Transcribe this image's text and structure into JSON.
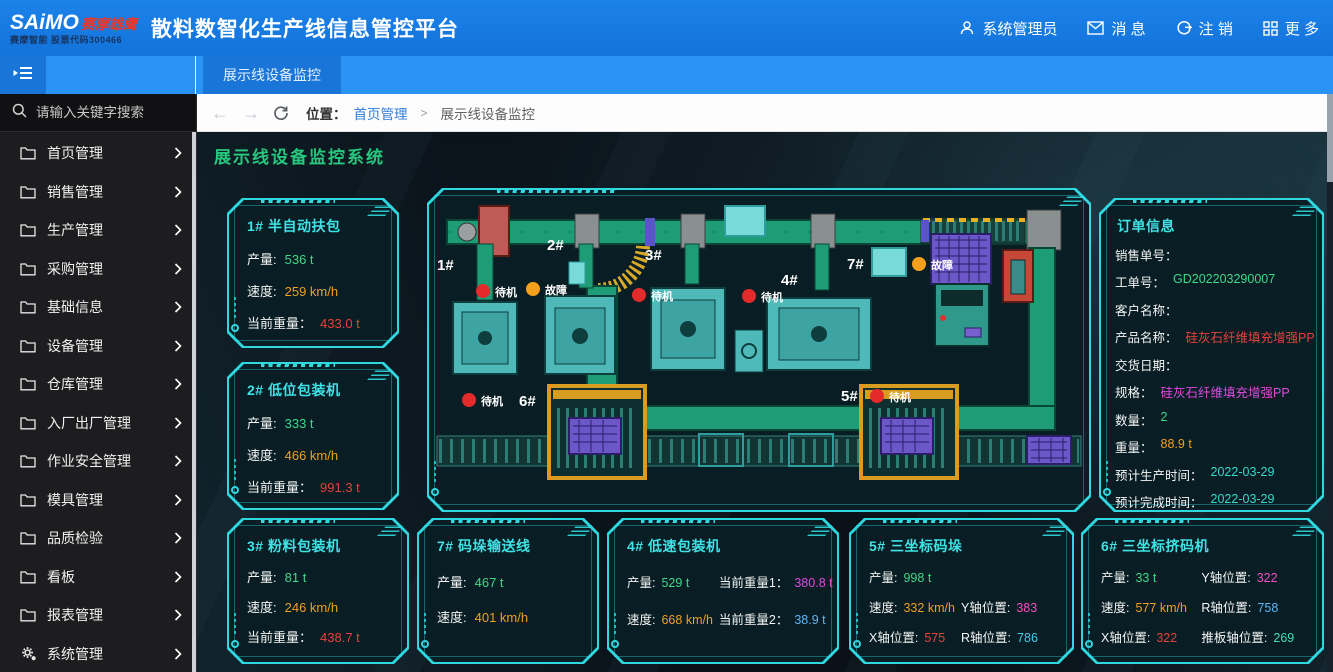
{
  "header": {
    "logo_main": "SAiMO",
    "logo_accent": "赛摩雄鹰",
    "logo_sub": "赛摩智能 股票代码300466",
    "title": "散料数智化生产线信息管控平台",
    "user": "系统管理员",
    "messages": "消 息",
    "logout": "注 销",
    "more": "更 多"
  },
  "tabbar": {
    "active_tab": "展示线设备监控"
  },
  "sidebar": {
    "search_placeholder": "请输入关键字搜索",
    "items": [
      {
        "label": "首页管理"
      },
      {
        "label": "销售管理"
      },
      {
        "label": "生产管理"
      },
      {
        "label": "采购管理"
      },
      {
        "label": "基础信息"
      },
      {
        "label": "设备管理"
      },
      {
        "label": "仓库管理"
      },
      {
        "label": "入厂出厂管理"
      },
      {
        "label": "作业安全管理"
      },
      {
        "label": "模具管理"
      },
      {
        "label": "品质检验"
      },
      {
        "label": "看板"
      },
      {
        "label": "报表管理"
      },
      {
        "label": "系统管理"
      }
    ]
  },
  "breadcrumb": {
    "location_label": "位置：",
    "root": "首页管理",
    "separator": ">",
    "current": "展示线设备监控"
  },
  "main": {
    "title": "展示线设备监控系统"
  },
  "panels": {
    "p1": {
      "title": "1# 半自动扶包",
      "rows": [
        {
          "label": "产量:",
          "value": "536 t"
        },
        {
          "label": "速度:",
          "value": "259 km/h"
        },
        {
          "label": "当前重量：",
          "value": "433.0 t"
        }
      ]
    },
    "p2": {
      "title": "2# 低位包装机",
      "rows": [
        {
          "label": "产量:",
          "value": "333 t"
        },
        {
          "label": "速度:",
          "value": "466 km/h"
        },
        {
          "label": "当前重量：",
          "value": "991.3 t"
        }
      ]
    },
    "p3": {
      "title": "3# 粉料包装机",
      "rows": [
        {
          "label": "产量:",
          "value": "81 t"
        },
        {
          "label": "速度:",
          "value": "246 km/h"
        },
        {
          "label": "当前重量：",
          "value": "438.7 t"
        }
      ]
    },
    "p7": {
      "title": "7# 码垛输送线",
      "rows": [
        {
          "label": "产量:",
          "value": "467 t"
        },
        {
          "label": "速度:",
          "value": "401 km/h"
        }
      ]
    },
    "p4": {
      "title": "4# 低速包装机",
      "cells": [
        {
          "label": "产量:",
          "value": "529 t"
        },
        {
          "label": "当前重量1：",
          "value": "380.8 t"
        },
        {
          "label": "速度:",
          "value": "668 km/h"
        },
        {
          "label": "当前重量2：",
          "value": "38.9 t"
        }
      ]
    },
    "p5": {
      "title": "5# 三坐标码垛",
      "cells": [
        {
          "label": "产量:",
          "value": "998 t"
        },
        {
          "label": "",
          "value": ""
        },
        {
          "label": "速度:",
          "value": "332 km/h"
        },
        {
          "label": "Y轴位置:",
          "value": "383"
        },
        {
          "label": "X轴位置:",
          "value": "575"
        },
        {
          "label": "R轴位置:",
          "value": "786"
        }
      ]
    },
    "p6": {
      "title": "6# 三坐标挤码机",
      "cells": [
        {
          "label": "产量:",
          "value": "33 t"
        },
        {
          "label": "Y轴位置:",
          "value": "322"
        },
        {
          "label": "速度:",
          "value": "577 km/h"
        },
        {
          "label": "R轴位置:",
          "value": "758"
        },
        {
          "label": "X轴位置:",
          "value": "322"
        },
        {
          "label": "推板轴位置:",
          "value": "269"
        }
      ]
    }
  },
  "order": {
    "title": "订单信息",
    "rows": [
      {
        "label": "销售单号：",
        "value": ""
      },
      {
        "label": "工单号：",
        "value": "GD202203290007"
      },
      {
        "label": "客户名称：",
        "value": ""
      },
      {
        "label": "产品名称：",
        "value": "硅灰石纤维填充增强PP"
      },
      {
        "label": "交货日期：",
        "value": ""
      },
      {
        "label": "规格：",
        "value": "硅灰石纤维填充增强PP"
      },
      {
        "label": "数量：",
        "value": "2"
      },
      {
        "label": "重量：",
        "value": "88.9 t"
      },
      {
        "label": "预计生产时间：",
        "value": "2022-03-29"
      },
      {
        "label": "预计完成时间：",
        "value": "2022-03-29"
      }
    ]
  },
  "diagram": {
    "stations": {
      "s1": {
        "id": "1#",
        "status": "待机"
      },
      "s2": {
        "id": "2#",
        "status": "故障"
      },
      "s3": {
        "id": "3#",
        "status": "待机"
      },
      "s4": {
        "id": "4#",
        "status": "待机"
      },
      "s5": {
        "id": "5#",
        "status": "待机"
      },
      "s6": {
        "id": "6#",
        "status": "待机"
      },
      "s7": {
        "id": "7#",
        "status": "故障"
      }
    },
    "status_colors": {
      "待机": "#e42b2b",
      "故障": "#f5a01c"
    }
  },
  "colors": {
    "accent_cyan": "#2fd8df",
    "title_green": "#27c77d",
    "value_green": "#3ed98a",
    "value_orange": "#f0a11e",
    "value_red": "#e8413c",
    "value_magenta": "#e04ae0",
    "value_pink": "#f152c1",
    "value_cyan": "#3bd2e8",
    "value_blue": "#5fb6f5",
    "value_teal": "#43dfb2",
    "value_date": "#35d9c9"
  }
}
